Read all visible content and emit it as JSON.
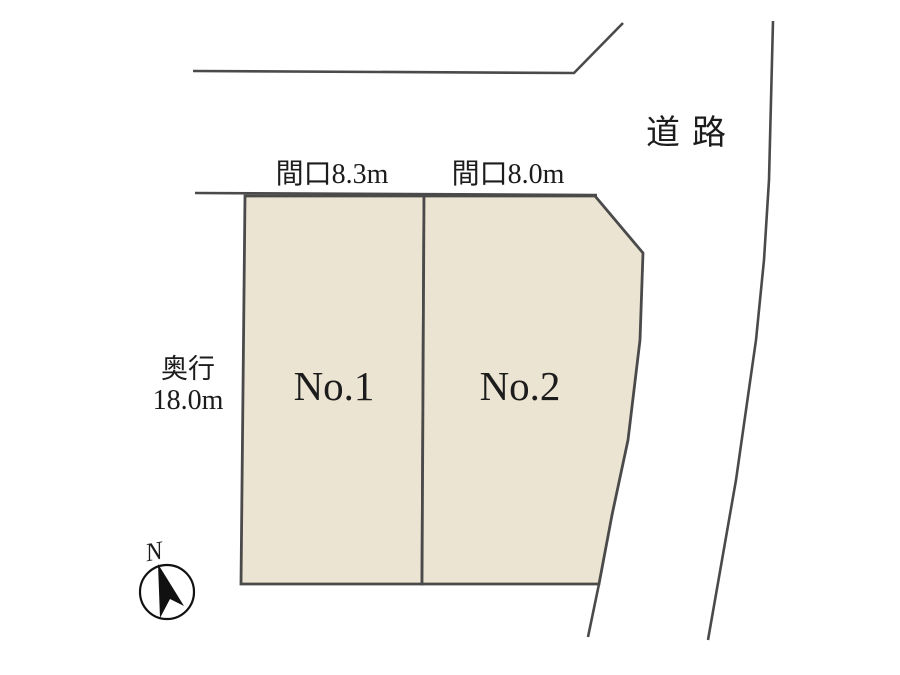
{
  "diagram": {
    "type": "land-plot-layout",
    "road": {
      "label": "道路"
    },
    "lots": [
      {
        "name": "No.1",
        "frontage_label": "間口8.3m",
        "frontage_m": 8.3
      },
      {
        "name": "No.2",
        "frontage_label": "間口8.0m",
        "frontage_m": 8.0
      }
    ],
    "depth": {
      "label": "奥行",
      "value_label": "18.0m",
      "value_m": 18.0
    },
    "compass": {
      "label": "N"
    }
  },
  "colors": {
    "lot_fill": "#ece4d2",
    "line": "#4a4a4a",
    "text": "#1c1c1c"
  }
}
